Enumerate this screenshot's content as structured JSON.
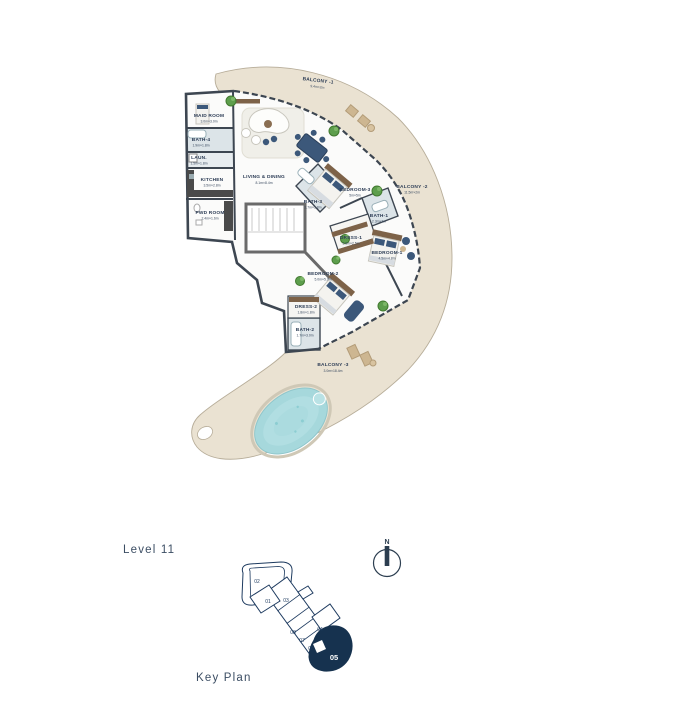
{
  "plan": {
    "rooms": [
      {
        "label": "BALCONY -1",
        "dims": "9.4m×2m"
      },
      {
        "label": "MAID ROOM",
        "dims": "3.0m×3.0m"
      },
      {
        "label": "BATH-4",
        "dims": "1.9m×1.8m"
      },
      {
        "label": "LAUN.",
        "dims": "1.5m×1.8m"
      },
      {
        "label": "KITCHEN",
        "dims": "3.5m×2.8m"
      },
      {
        "label": "PWD ROOM",
        "dims": "2.4m×1.6m"
      },
      {
        "label": "LIVING & DINING",
        "dims": "8.1m×8.4m"
      },
      {
        "label": "BATH-3",
        "dims": "2.7m×1.8m"
      },
      {
        "label": "BEDROOM-3",
        "dims": "5m×5m"
      },
      {
        "label": "BALCONY -2",
        "dims": "11.5m×2m"
      },
      {
        "label": "BATH-1",
        "dims": "2.3m×3m"
      },
      {
        "label": "DRESS-1",
        "dims": "3.8m×2.5m"
      },
      {
        "label": "BEDROOM-1",
        "dims": "4.5m×4.8m"
      },
      {
        "label": "BEDROOM-2",
        "dims": "5.0m×5.0m"
      },
      {
        "label": "DRESS-2",
        "dims": "1.8m×1.8m"
      },
      {
        "label": "BATH-2",
        "dims": "1.7m×3.0m"
      },
      {
        "label": "BALCONY -3",
        "dims": "3.0m×18.4m"
      }
    ],
    "colors": {
      "wall": "#3d4651",
      "balcony_floor": "#eae2d2",
      "pool_water": "#a6d8dc",
      "accent_navy": "#3c587a",
      "label_text": "#2c3c55",
      "keyplan_navy": "#1d3a5f"
    }
  },
  "footer": {
    "level_label": "Level 11",
    "north_label": "N",
    "key_plan_label": "Key Plan"
  },
  "key_plan": {
    "highlighted_unit": "05",
    "units": [
      {
        "num": "01"
      },
      {
        "num": "02"
      },
      {
        "num": "03"
      },
      {
        "num": "04"
      },
      {
        "num": "05"
      },
      {
        "num": "06"
      },
      {
        "num": "07"
      },
      {
        "num": "08"
      }
    ]
  }
}
